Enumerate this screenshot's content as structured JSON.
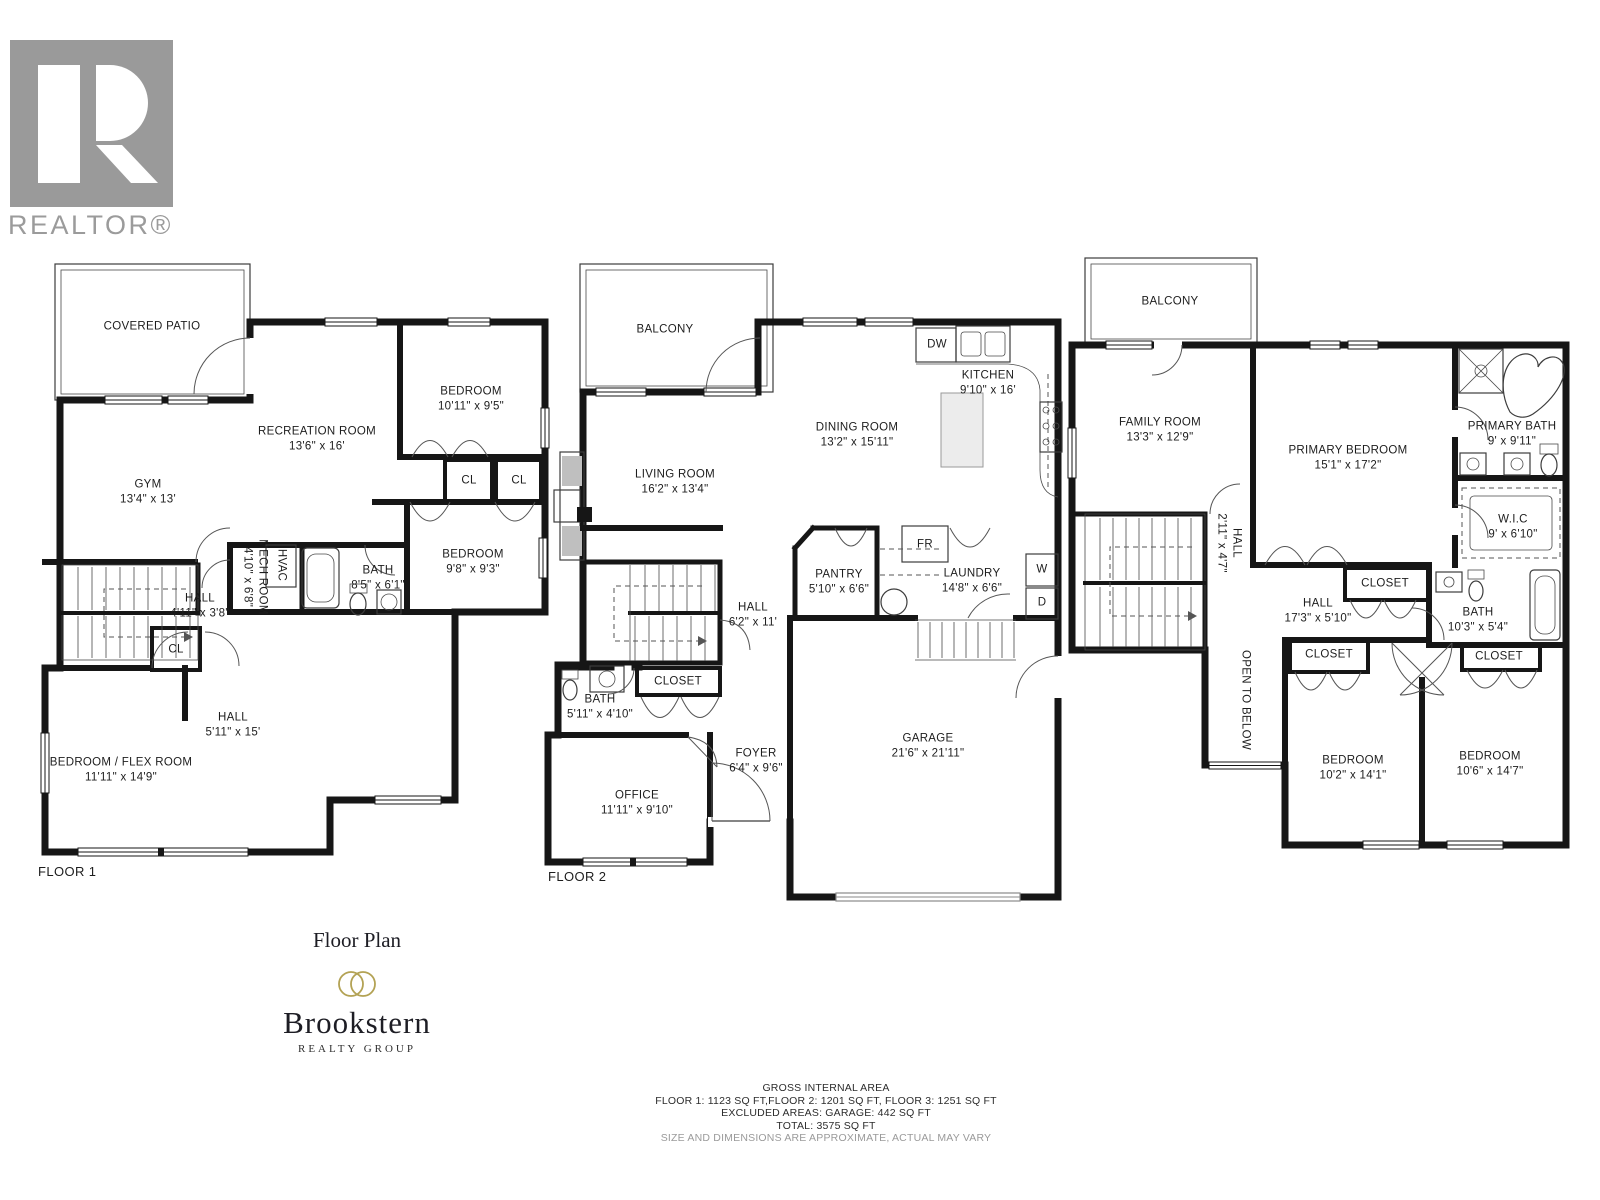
{
  "branding": {
    "realtor_logo_text": "REALTOR®",
    "floor_plan_title": "Floor Plan",
    "brand_name": "Brookstern",
    "brand_subtitle": "REALTY GROUP"
  },
  "footer": {
    "line1": "GROSS INTERNAL AREA",
    "line2": "FLOOR 1: 1123 SQ FT,FLOOR 2: 1201 SQ FT, FLOOR 3: 1251 SQ FT",
    "line3": "EXCLUDED AREAS: GARAGE: 442 SQ FT",
    "line4": "TOTAL: 3575 SQ FT",
    "line5": "SIZE AND DIMENSIONS ARE APPROXIMATE, ACTUAL MAY VARY"
  },
  "floors": [
    {
      "label": "FLOOR 1",
      "rooms": [
        {
          "name": "COVERED PATIO",
          "dims": ""
        },
        {
          "name": "RECREATION ROOM",
          "dims": "13'6\" x 16'"
        },
        {
          "name": "BEDROOM",
          "dims": "10'11\" x 9'5\""
        },
        {
          "name": "GYM",
          "dims": "13'4\" x 13'"
        },
        {
          "name": "CL",
          "dims": ""
        },
        {
          "name": "CL",
          "dims": ""
        },
        {
          "name": "BATH",
          "dims": "8'5\" x 6'1\""
        },
        {
          "name": "MECH ROOM",
          "dims": "4'10\" x 6'8\""
        },
        {
          "name": "HVAC",
          "dims": ""
        },
        {
          "name": "HALL",
          "dims": "4'11\" x 3'8\""
        },
        {
          "name": "CL",
          "dims": ""
        },
        {
          "name": "BEDROOM",
          "dims": "9'8\" x 9'3\""
        },
        {
          "name": "HALL",
          "dims": "5'11\" x 15'"
        },
        {
          "name": "BEDROOM / FLEX ROOM",
          "dims": "11'11\" x 14'9\""
        }
      ]
    },
    {
      "label": "FLOOR 2",
      "rooms": [
        {
          "name": "BALCONY",
          "dims": ""
        },
        {
          "name": "LIVING ROOM",
          "dims": "16'2\" x 13'4\""
        },
        {
          "name": "DINING ROOM",
          "dims": "13'2\" x 15'11\""
        },
        {
          "name": "KITCHEN",
          "dims": "9'10\" x 16'"
        },
        {
          "name": "DW",
          "dims": ""
        },
        {
          "name": "PANTRY",
          "dims": "5'10\" x 6'6\""
        },
        {
          "name": "FR",
          "dims": ""
        },
        {
          "name": "LAUNDRY",
          "dims": "14'8\" x 6'6\""
        },
        {
          "name": "W",
          "dims": ""
        },
        {
          "name": "D",
          "dims": ""
        },
        {
          "name": "HALL",
          "dims": "6'2\" x 11'"
        },
        {
          "name": "CLOSET",
          "dims": ""
        },
        {
          "name": "BATH",
          "dims": "5'11\" x 4'10\""
        },
        {
          "name": "FOYER",
          "dims": "6'4\" x 9'6\""
        },
        {
          "name": "OFFICE",
          "dims": "11'11\" x 9'10\""
        },
        {
          "name": "GARAGE",
          "dims": "21'6\" x 21'11\""
        }
      ]
    },
    {
      "label": "",
      "rooms": [
        {
          "name": "BALCONY",
          "dims": ""
        },
        {
          "name": "FAMILY ROOM",
          "dims": "13'3\" x 12'9\""
        },
        {
          "name": "PRIMARY BEDROOM",
          "dims": "15'1\" x 17'2\""
        },
        {
          "name": "PRIMARY BATH",
          "dims": "9' x 9'11\""
        },
        {
          "name": "W.I.C",
          "dims": "9' x 6'10\""
        },
        {
          "name": "HALL",
          "dims": "2'11\" x 4'7\""
        },
        {
          "name": "HALL",
          "dims": "17'3\" x 5'10\""
        },
        {
          "name": "CLOSET",
          "dims": ""
        },
        {
          "name": "BATH",
          "dims": "10'3\" x 5'4\""
        },
        {
          "name": "CLOSET",
          "dims": ""
        },
        {
          "name": "CLOSET",
          "dims": ""
        },
        {
          "name": "OPEN TO BELOW",
          "dims": ""
        },
        {
          "name": "BEDROOM",
          "dims": "10'2\" x 14'1\""
        },
        {
          "name": "BEDROOM",
          "dims": "10'6\" x 14'7\""
        }
      ]
    }
  ]
}
